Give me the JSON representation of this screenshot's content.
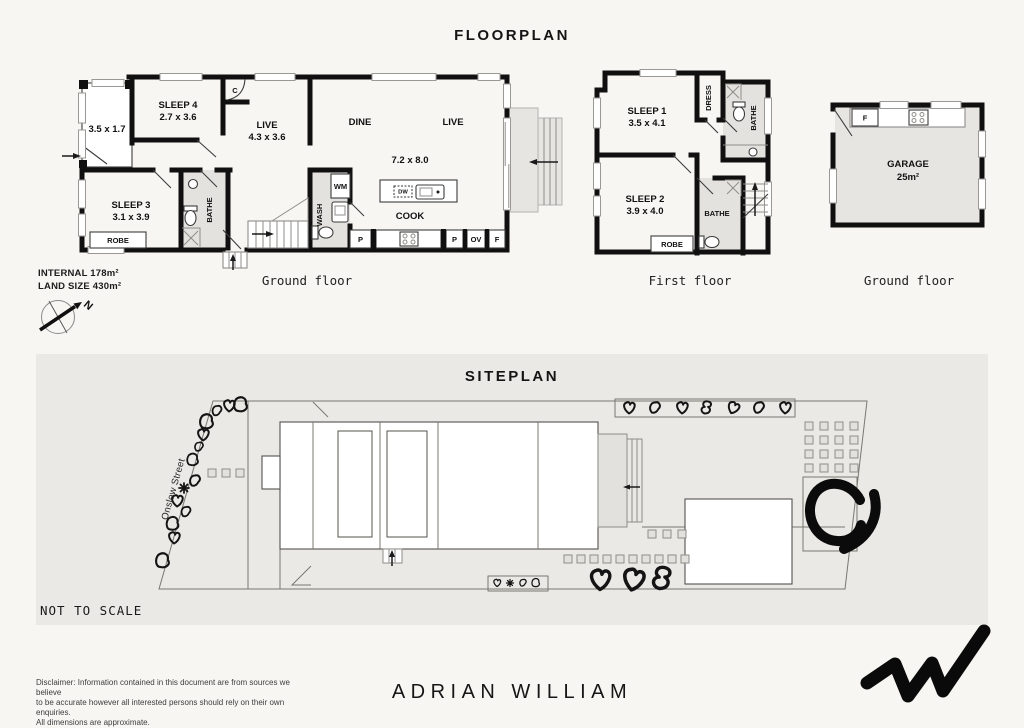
{
  "page": {
    "title": "FLOORPLAN",
    "internal_area": "INTERNAL 178m²",
    "land_size": "LAND SIZE 430m²",
    "brand": "ADRIAN WILLIAM",
    "disclaimer": [
      "Disclaimer: Information contained in this document are from sources we believe",
      "to be accurate however all interested persons should rely on their own enquiries.",
      "All dimensions are approximate."
    ],
    "colors": {
      "wall": "#101010",
      "wet_area": "#e3e2df",
      "band_bg": "#eae9e6",
      "page_bg": "#f7f6f3"
    }
  },
  "compass": {
    "north": "N"
  },
  "floors": {
    "ground": {
      "label": "Ground floor",
      "porch_dim": "3.5 x 1.7",
      "sleep4": "SLEEP 4",
      "sleep4_dim": "2.7 x 3.6",
      "closet": "C",
      "live": "LIVE",
      "live_dim": "4.3 x 3.6",
      "dine": "DINE",
      "live2": "LIVE",
      "open_dim": "7.2 x 8.0",
      "cook": "COOK",
      "sleep3": "SLEEP 3",
      "sleep3_dim": "3.1 x 3.9",
      "robe": "ROBE",
      "bathe": "BATHE",
      "wash": "WASH",
      "wm": "WM",
      "dw": "DW",
      "pantry1": "P",
      "pantry2": "P",
      "oven": "OV",
      "fridge": "F"
    },
    "first": {
      "label": "First floor",
      "sleep1": "SLEEP 1",
      "sleep1_dim": "3.5 x 4.1",
      "dress": "DRESS",
      "bathe1": "BATHE",
      "sleep2": "SLEEP 2",
      "sleep2_dim": "3.9 x 4.0",
      "bathe2": "BATHE",
      "robe": "ROBE"
    },
    "garage": {
      "label": "Ground floor",
      "name": "GARAGE",
      "area": "25m²",
      "fridge": "F"
    }
  },
  "siteplan": {
    "title": "SITEPLAN",
    "street": "Onslow Street",
    "not_to_scale": "NOT TO SCALE"
  }
}
